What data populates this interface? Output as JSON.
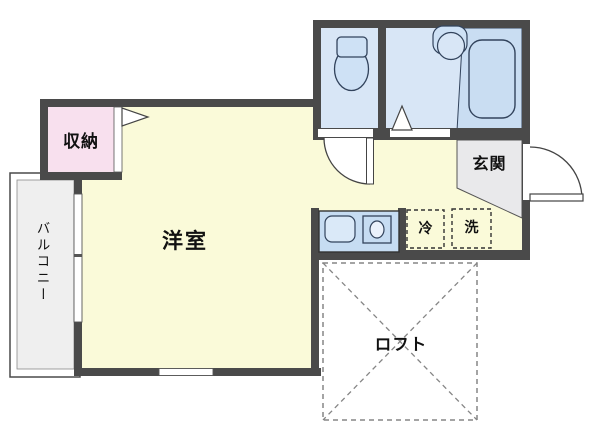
{
  "plan_title": "apartment-floor-plan",
  "rooms": {
    "main_room": {
      "label": "洋室"
    },
    "closet": {
      "label": "収納"
    },
    "balcony": {
      "label": "バルコニー"
    },
    "entrance": {
      "label": "玄関"
    },
    "loft": {
      "label": "ロフト"
    }
  },
  "appliances": {
    "refrigerator": {
      "label": "冷"
    },
    "washer": {
      "label": "洗"
    }
  },
  "fixture_icons": [
    "toilet-icon",
    "washbasin-icon",
    "bathtub-icon",
    "kitchen-sink-icon",
    "stove-burner-icon",
    "door-swing-arc-icon",
    "door-triangle-icon"
  ],
  "colors": {
    "wall": "#4a4a4a",
    "room_yellow": "#fafad9",
    "wet_area_blue": "#d8e6f6",
    "bath_blue": "#c9ddf2",
    "closet_pink": "#f8e0ee",
    "entrance_gray": "#e9e9eb",
    "balcony_gray": "#efefef",
    "loft_dash_gray": "#858585",
    "text": "#111111"
  }
}
